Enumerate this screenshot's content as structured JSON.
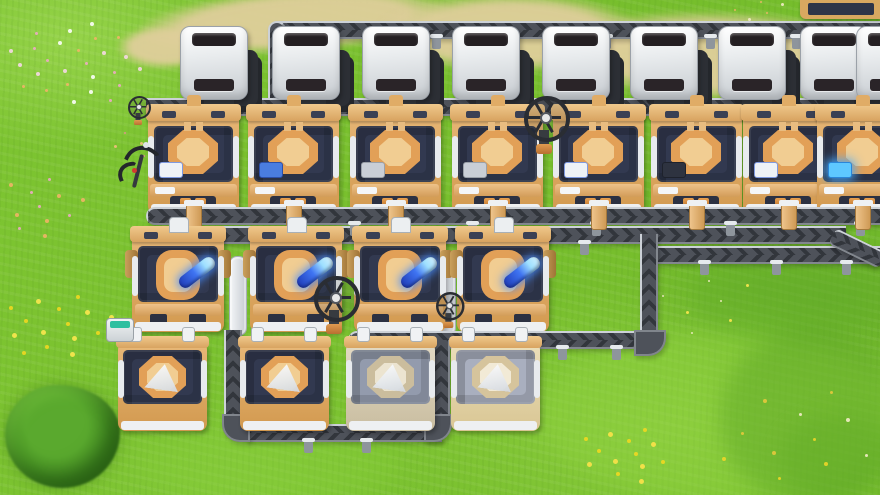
{
  "meta": {
    "app": "factory-automation-game",
    "view": "top-down-factory-screenshot",
    "viewport": {
      "width": 880,
      "height": 495
    }
  },
  "palette": {
    "grass_base": "#7cc42f",
    "grass_light": "#93d444",
    "grass_dark": "#5fa826",
    "dirt_path": "#dfce9b",
    "belt_base": "#4e525a",
    "belt_edge": "#ccd1d7",
    "machine_tan": "#e8b878",
    "machine_deck_navy": "#323950",
    "machine_white": "#eef0f2",
    "container_white": "#e9ecee",
    "item_blue_rod": "#3f74f2",
    "flower_yellow": "#f2d820",
    "flower_pink": "#f0a8c8",
    "bush_green": "#458f23"
  },
  "terrain": {
    "dirt_patches": [
      {
        "x": 140,
        "y": -10,
        "w": 310,
        "h": 62,
        "rot": -4
      },
      {
        "x": 380,
        "y": -6,
        "w": 260,
        "h": 78,
        "rot": 0
      },
      {
        "x": 555,
        "y": 12,
        "w": 335,
        "h": 88,
        "rot": 2
      },
      {
        "x": 118,
        "y": 26,
        "w": 95,
        "h": 42,
        "rot": 0
      },
      {
        "x": 834,
        "y": 36,
        "w": 72,
        "h": 52,
        "rot": 0
      }
    ],
    "shade_patches": [
      {
        "x": 540,
        "y": 330,
        "w": 360,
        "h": 170,
        "c": "#8fd23f",
        "o": 0.45
      },
      {
        "x": 140,
        "y": 428,
        "w": 260,
        "h": 75,
        "c": "#88cf3a",
        "o": 0.35
      },
      {
        "x": 690,
        "y": 252,
        "w": 195,
        "h": 88,
        "c": "#66af2a",
        "o": 0.5
      },
      {
        "x": 720,
        "y": 330,
        "w": 180,
        "h": 175,
        "c": "#57a024",
        "o": 0.4
      },
      {
        "x": 430,
        "y": 248,
        "w": 125,
        "h": 72,
        "c": "#68b02a",
        "o": 0.35
      },
      {
        "x": 780,
        "y": 415,
        "w": 115,
        "h": 85,
        "c": "#5fa826",
        "o": 0.35
      }
    ],
    "flower_clusters": [
      {
        "cx": 75,
        "cy": 62,
        "r": 70,
        "n": 26,
        "size": 3,
        "colors": [
          "#f0a8c8",
          "#f8d8e8",
          "#f2b468",
          "#ffffff"
        ]
      },
      {
        "cx": 28,
        "cy": 205,
        "r": 55,
        "n": 14,
        "size": 3,
        "colors": [
          "#f0a8c8",
          "#f2b468"
        ]
      },
      {
        "cx": 152,
        "cy": 135,
        "r": 42,
        "n": 10,
        "size": 2,
        "colors": [
          "#e89090",
          "#f2c080"
        ]
      },
      {
        "cx": 55,
        "cy": 322,
        "r": 58,
        "n": 15,
        "size": 4,
        "colors": [
          "#f2d820",
          "#ffe850"
        ]
      },
      {
        "cx": 625,
        "cy": 452,
        "r": 48,
        "n": 13,
        "size": 4,
        "colors": [
          "#f2d820",
          "#ffe34a"
        ]
      },
      {
        "cx": 795,
        "cy": 438,
        "r": 85,
        "n": 11,
        "size": 3,
        "colors": [
          "#f0d628",
          "#e8c83c",
          "#f6eecb"
        ]
      },
      {
        "cx": 705,
        "cy": 300,
        "r": 55,
        "n": 7,
        "size": 2,
        "colors": [
          "#f6eecb",
          "#ffe850"
        ]
      },
      {
        "cx": 758,
        "cy": 12,
        "r": 28,
        "n": 6,
        "size": 2,
        "colors": [
          "#f2b468",
          "#f6eecb"
        ]
      }
    ],
    "bush": {
      "x": 5,
      "y": 385,
      "w": 115,
      "h": 103
    }
  },
  "belts": {
    "segments": [
      {
        "id": "top-line",
        "dir": "h",
        "x": 278,
        "y": 21,
        "len": 602,
        "z": 1
      },
      {
        "id": "top-drop",
        "dir": "v",
        "x": 268,
        "y": 21,
        "len": 104,
        "z": 1,
        "cap": "top"
      },
      {
        "id": "row1-bus",
        "dir": "h",
        "x": 146,
        "y": 98,
        "len": 734,
        "z": 3
      },
      {
        "id": "mid-bus-upper",
        "dir": "h",
        "x": 146,
        "y": 207,
        "len": 734,
        "z": 5,
        "cap": "left"
      },
      {
        "id": "mid-bus-lower",
        "dir": "h",
        "x": 146,
        "y": 226,
        "len": 700,
        "z": 5
      },
      {
        "id": "right-out",
        "dir": "h",
        "x": 650,
        "y": 246,
        "len": 230,
        "z": 5
      },
      {
        "id": "mid-drop",
        "dir": "v",
        "x": 640,
        "y": 234,
        "len": 102,
        "z": 5
      },
      {
        "id": "row4-feed",
        "dir": "h",
        "x": 348,
        "y": 331,
        "len": 300,
        "z": 7,
        "cap": "left"
      },
      {
        "id": "gap-drop-right",
        "dir": "v",
        "x": 432,
        "y": 340,
        "len": 88,
        "z": 7
      },
      {
        "id": "bottom-link",
        "dir": "h",
        "x": 246,
        "y": 424,
        "len": 196,
        "z": 7
      },
      {
        "id": "gap-drop-left",
        "dir": "v",
        "x": 224,
        "y": 330,
        "len": 98,
        "z": 7
      }
    ],
    "jogs": [
      {
        "id": "edge-s-curve",
        "x": 836,
        "y": 228,
        "len": 56,
        "rot": 26,
        "z": 5
      }
    ],
    "corners": [
      {
        "x": 634,
        "y": 330,
        "w": 32,
        "h": 26,
        "round": "br",
        "z": 7
      },
      {
        "x": 424,
        "y": 414,
        "w": 28,
        "h": 28,
        "round": "br",
        "z": 7
      },
      {
        "x": 222,
        "y": 414,
        "w": 28,
        "h": 28,
        "round": "bl",
        "z": 7
      }
    ],
    "lifts": [
      {
        "x": 229,
        "y": 256,
        "h": 78,
        "z": 6
      },
      {
        "x": 438,
        "y": 264,
        "h": 70,
        "z": 6
      }
    ],
    "feet": [
      {
        "x": 432,
        "y": 37,
        "z": 1
      },
      {
        "x": 602,
        "y": 37,
        "z": 1
      },
      {
        "x": 706,
        "y": 37,
        "z": 1
      },
      {
        "x": 792,
        "y": 37,
        "z": 1
      },
      {
        "x": 350,
        "y": 224,
        "z": 5
      },
      {
        "x": 468,
        "y": 224,
        "z": 5
      },
      {
        "x": 592,
        "y": 224,
        "z": 5
      },
      {
        "x": 726,
        "y": 224,
        "z": 5
      },
      {
        "x": 856,
        "y": 224,
        "z": 5
      },
      {
        "x": 310,
        "y": 243,
        "z": 5
      },
      {
        "x": 486,
        "y": 243,
        "z": 5
      },
      {
        "x": 580,
        "y": 243,
        "z": 5
      },
      {
        "x": 700,
        "y": 263,
        "z": 5
      },
      {
        "x": 772,
        "y": 263,
        "z": 5
      },
      {
        "x": 842,
        "y": 263,
        "z": 5
      },
      {
        "x": 558,
        "y": 348,
        "z": 7
      },
      {
        "x": 612,
        "y": 348,
        "z": 7
      },
      {
        "x": 304,
        "y": 441,
        "z": 7
      },
      {
        "x": 362,
        "y": 441,
        "z": 7
      }
    ],
    "stubs": [
      {
        "x": 186,
        "y": 204,
        "h": 24,
        "z": 6
      },
      {
        "x": 286,
        "y": 204,
        "h": 24,
        "z": 6
      },
      {
        "x": 388,
        "y": 204,
        "h": 24,
        "z": 6
      },
      {
        "x": 490,
        "y": 204,
        "h": 24,
        "z": 6
      },
      {
        "x": 591,
        "y": 204,
        "h": 24,
        "z": 6
      },
      {
        "x": 689,
        "y": 204,
        "h": 24,
        "z": 6
      },
      {
        "x": 781,
        "y": 204,
        "h": 24,
        "z": 6
      },
      {
        "x": 855,
        "y": 204,
        "h": 24,
        "z": 6
      }
    ]
  },
  "machines_cfg": {
    "variants": {
      "orange": {
        "body": "#e8b878",
        "body2": "#d2994f",
        "deck": "#323950",
        "ring": "#e2a057",
        "pad": "#f1cd92"
      },
      "pale": {
        "body": "#e3dac4",
        "body2": "#c9bda0",
        "deck": "#939bad",
        "ring": "#cbbd9d",
        "pad": "#ece4d0"
      },
      "cream": {
        "body": "#ecdfba",
        "body2": "#d9c694",
        "deck": "#a9afbf",
        "ring": "#d6c49c",
        "pad": "#f2ead6"
      }
    },
    "accents": {
      "white-blue": {
        "bg": "#eef2f6",
        "border": "#7f9ae0",
        "glow": ""
      },
      "blue-canister": {
        "bg": "#4a7de0",
        "border": "#2c4fa8",
        "glow": ""
      },
      "panel": {
        "bg": "#c9ced6",
        "border": "#9aa0a8",
        "glow": ""
      },
      "dark": {
        "bg": "#2e3340",
        "border": "#1e222c",
        "glow": ""
      },
      "blue-glow": {
        "bg": "#5ec8ff",
        "border": "#2a86d8",
        "glow": "0 0 10px 3px rgba(70,170,255,0.85)"
      }
    }
  },
  "machines": [
    {
      "type": "container",
      "name": "smelter-machine",
      "x": 180,
      "y": 26,
      "z": 4
    },
    {
      "type": "container",
      "name": "smelter-machine",
      "x": 272,
      "y": 26,
      "z": 4
    },
    {
      "type": "container",
      "name": "smelter-machine",
      "x": 362,
      "y": 26,
      "z": 4
    },
    {
      "type": "container",
      "name": "smelter-machine",
      "x": 452,
      "y": 26,
      "z": 4
    },
    {
      "type": "container",
      "name": "smelter-machine",
      "x": 542,
      "y": 26,
      "z": 4
    },
    {
      "type": "container",
      "name": "smelter-machine",
      "x": 630,
      "y": 26,
      "z": 4
    },
    {
      "type": "container",
      "name": "smelter-machine",
      "x": 718,
      "y": 26,
      "z": 4
    },
    {
      "type": "container",
      "name": "smelter-machine",
      "x": 800,
      "y": 26,
      "z": 4
    },
    {
      "type": "container",
      "name": "smelter-machine",
      "x": 856,
      "y": 26,
      "z": 4
    },
    {
      "type": "assembler_a",
      "name": "assembler-machine",
      "x": 146,
      "y": 102,
      "z": 4,
      "variant": "orange",
      "accent": "white-blue"
    },
    {
      "type": "assembler_a",
      "name": "assembler-machine",
      "x": 246,
      "y": 102,
      "z": 4,
      "variant": "orange",
      "accent": "blue-canister"
    },
    {
      "type": "assembler_a",
      "name": "assembler-machine",
      "x": 348,
      "y": 102,
      "z": 4,
      "variant": "orange",
      "accent": "panel"
    },
    {
      "type": "assembler_a",
      "name": "assembler-machine",
      "x": 450,
      "y": 102,
      "z": 4,
      "variant": "orange",
      "accent": "panel"
    },
    {
      "type": "assembler_a",
      "name": "assembler-machine",
      "x": 551,
      "y": 102,
      "z": 4,
      "variant": "orange",
      "accent": "white-blue"
    },
    {
      "type": "assembler_a",
      "name": "assembler-machine",
      "x": 649,
      "y": 102,
      "z": 4,
      "variant": "orange",
      "accent": "dark"
    },
    {
      "type": "assembler_a",
      "name": "assembler-machine",
      "x": 741,
      "y": 102,
      "z": 4,
      "variant": "orange",
      "accent": "white-blue"
    },
    {
      "type": "assembler_a",
      "name": "assembler-machine",
      "x": 815,
      "y": 102,
      "z": 4,
      "variant": "orange",
      "accent": "blue-glow"
    },
    {
      "type": "assembler_b",
      "name": "refinery-machine-blue-rod",
      "x": 130,
      "y": 226,
      "z": 6,
      "variant": "orange"
    },
    {
      "type": "assembler_b",
      "name": "refinery-machine-blue-rod",
      "x": 248,
      "y": 226,
      "z": 6,
      "variant": "orange"
    },
    {
      "type": "assembler_b",
      "name": "refinery-machine-blue-rod",
      "x": 352,
      "y": 226,
      "z": 6,
      "variant": "orange"
    },
    {
      "type": "assembler_b",
      "name": "refinery-machine-blue-rod",
      "x": 455,
      "y": 226,
      "z": 6,
      "variant": "orange"
    },
    {
      "type": "assembler_c",
      "name": "fabricator-machine-prism",
      "x": 116,
      "y": 336,
      "z": 8,
      "variant": "orange"
    },
    {
      "type": "assembler_c",
      "name": "fabricator-machine-prism",
      "x": 238,
      "y": 336,
      "z": 8,
      "variant": "orange"
    },
    {
      "type": "assembler_c",
      "name": "fabricator-machine-prism",
      "x": 344,
      "y": 336,
      "z": 8,
      "variant": "pale"
    },
    {
      "type": "assembler_c",
      "name": "fabricator-machine-prism",
      "x": 449,
      "y": 336,
      "z": 8,
      "variant": "cream"
    }
  ],
  "poles": [
    {
      "x": 524,
      "y": 96,
      "scale": 1
    },
    {
      "x": 314,
      "y": 276,
      "scale": 1
    },
    {
      "x": 436,
      "y": 292,
      "scale": 0.62
    },
    {
      "x": 128,
      "y": 96,
      "scale": 0.5
    }
  ],
  "props": {
    "character": {
      "x": 116,
      "y": 140
    },
    "teal_box": {
      "x": 106,
      "y": 318
    },
    "edge_machine_strip": {
      "x": 800,
      "y": 0,
      "w": 80,
      "h": 19
    }
  }
}
